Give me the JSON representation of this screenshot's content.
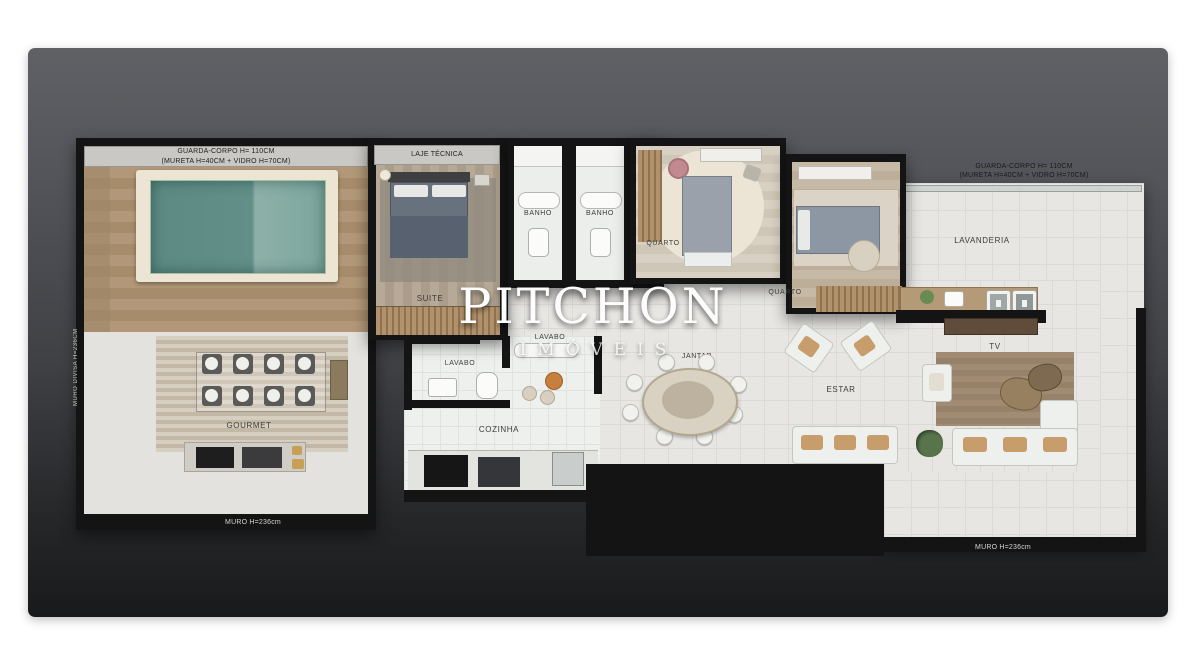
{
  "watermark": {
    "brand": "PITCHON",
    "subtitle": "IMÓVEIS"
  },
  "annotations": {
    "guard_corpo_line1": "GUARDA-CORPO H= 110CM",
    "guard_corpo_line2": "(MURETA H=40CM + VIDRO H=70CM)",
    "laje_tecnica": "LAJE TÉCNICA",
    "muro_left": "MURO H=236cm",
    "muro_right": "MURO H=236cm",
    "muro_divisa": "MURO DIVISA H=236CM"
  },
  "rooms": {
    "suite": "SUITE",
    "banho_1": "BANHO",
    "banho_2": "BANHO",
    "quarto_1": "QUARTO",
    "quarto_2": "QUARTO",
    "lavanderia": "LAVANDERIA",
    "lavabo_1": "LAVABO",
    "lavabo_2": "LAVABO",
    "cozinha": "COZINHA",
    "jantar": "JANTAR",
    "estar": "ESTAR",
    "tv": "TV",
    "gourmet": "GOURMET"
  },
  "colors": {
    "panel_top": "#5f6165",
    "panel_bottom": "#191a1c",
    "wall": "#141414",
    "floor_tile": "#e7e6e3",
    "wood_deck": "#ab9173",
    "pool_water": "#628e87",
    "watermark": "#fdfdfd"
  }
}
